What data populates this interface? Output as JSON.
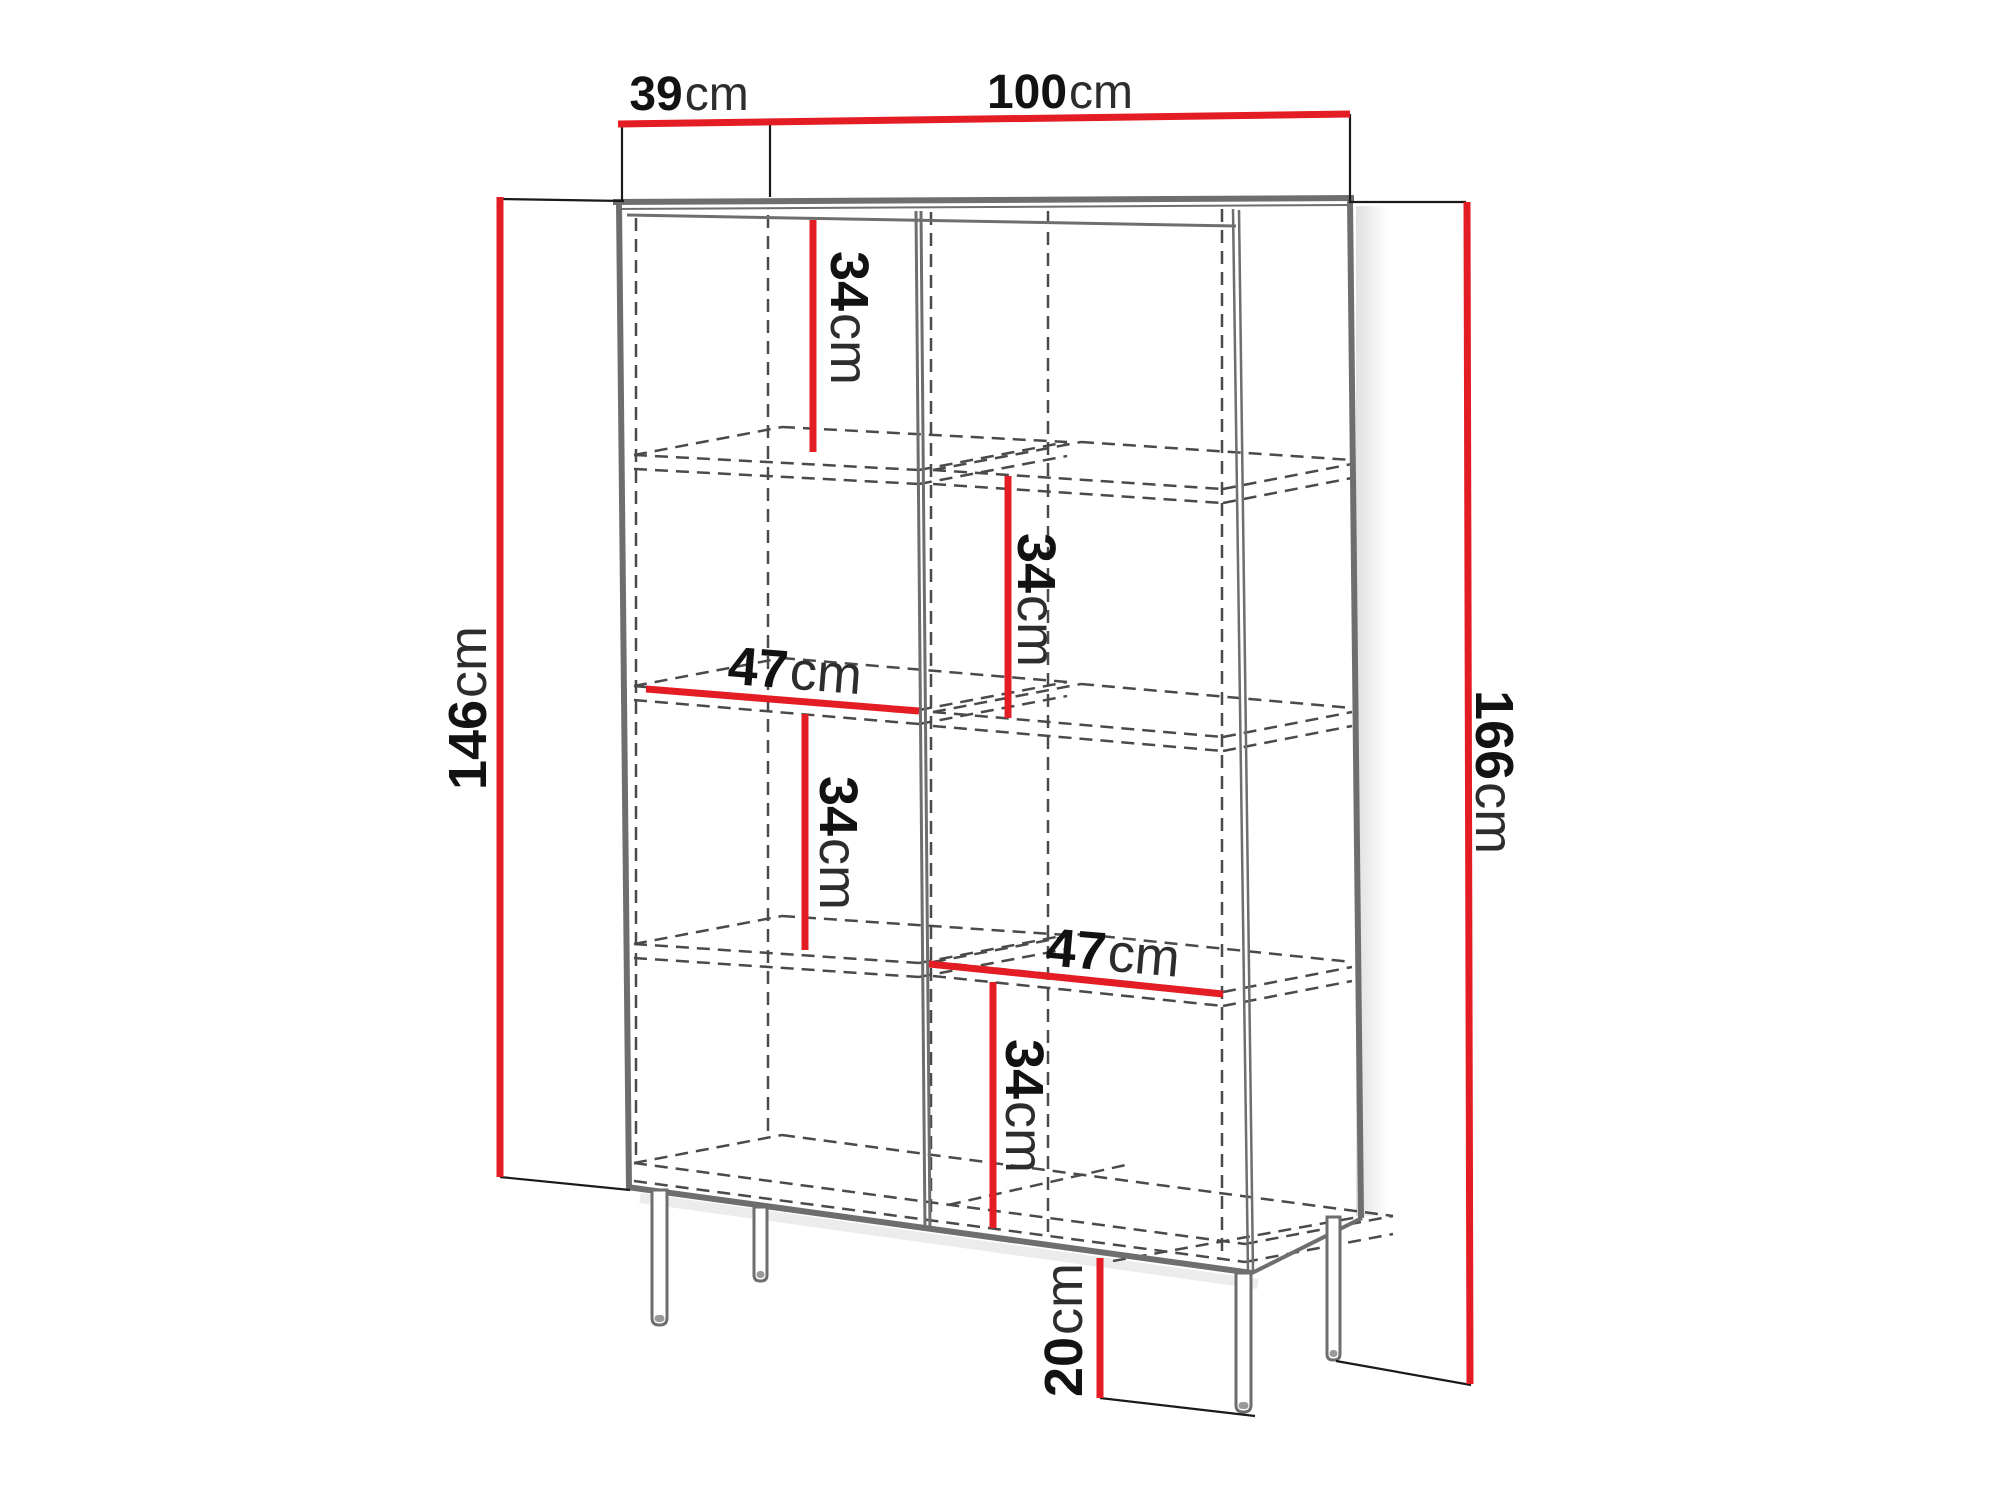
{
  "canvas": {
    "width": 2000,
    "height": 1499,
    "background": "#ffffff"
  },
  "palette": {
    "dimension_red": "#e41c23",
    "cabinet_gray": "#6e6e6e",
    "hidden_gray": "#4a4a4a",
    "extension_black": "#1a1a1a",
    "number_ink": "#121212",
    "unit_ink": "#2d2d2d"
  },
  "cabinet": {
    "solid_edges": [
      {
        "id": "top-outer-edge",
        "x1": 613,
        "y1": 202,
        "x2": 1354,
        "y2": 198,
        "w": 6
      },
      {
        "id": "top-inner-thin-edge",
        "x1": 617,
        "y1": 209,
        "x2": 1350,
        "y2": 205,
        "w": 2
      },
      {
        "id": "top-panel-bottom-edge",
        "x1": 627,
        "y1": 215,
        "x2": 1236,
        "y2": 226,
        "w": 3
      },
      {
        "id": "left-outer-edge",
        "x1": 619,
        "y1": 203,
        "x2": 629,
        "y2": 1189,
        "w": 6
      },
      {
        "id": "bottom-front-edge",
        "x1": 627,
        "y1": 1187,
        "x2": 1252,
        "y2": 1273,
        "w": 6
      },
      {
        "id": "front-right-edge-a",
        "x1": 1233,
        "y1": 209,
        "x2": 1248,
        "y2": 1271,
        "w": 2.5
      },
      {
        "id": "front-right-edge-b",
        "x1": 1239,
        "y1": 210,
        "x2": 1253,
        "y2": 1272,
        "w": 2.5
      },
      {
        "id": "back-right-edge",
        "x1": 1350,
        "y1": 200,
        "x2": 1361,
        "y2": 1218,
        "w": 6
      },
      {
        "id": "side-bottom-edge",
        "x1": 1252,
        "y1": 1273,
        "x2": 1362,
        "y2": 1218,
        "w": 4
      },
      {
        "id": "center-divider-a",
        "x1": 916,
        "y1": 211,
        "x2": 925,
        "y2": 1231,
        "w": 3
      },
      {
        "id": "center-divider-b",
        "x1": 921,
        "y1": 211,
        "x2": 930,
        "y2": 1231,
        "w": 3
      }
    ],
    "hidden_edges": [
      {
        "x1": 636,
        "y1": 218,
        "x2": 636,
        "y2": 1163
      },
      {
        "x1": 768,
        "y1": 215,
        "x2": 768,
        "y2": 1134
      },
      {
        "x1": 931,
        "y1": 212,
        "x2": 931,
        "y2": 1222
      },
      {
        "x1": 1048,
        "y1": 211,
        "x2": 1048,
        "y2": 1236
      },
      {
        "x1": 1222,
        "y1": 209,
        "x2": 1222,
        "y2": 1259
      },
      {
        "x1": 634,
        "y1": 455,
        "x2": 919,
        "y2": 470
      },
      {
        "x1": 634,
        "y1": 469,
        "x2": 919,
        "y2": 484
      },
      {
        "x1": 782,
        "y1": 427,
        "x2": 1067,
        "y2": 442
      },
      {
        "x1": 634,
        "y1": 455,
        "x2": 782,
        "y2": 427
      },
      {
        "x1": 919,
        "y1": 470,
        "x2": 1067,
        "y2": 442
      },
      {
        "x1": 919,
        "y1": 484,
        "x2": 1067,
        "y2": 456
      },
      {
        "x1": 634,
        "y1": 686,
        "x2": 919,
        "y2": 710
      },
      {
        "x1": 634,
        "y1": 700,
        "x2": 919,
        "y2": 724
      },
      {
        "x1": 782,
        "y1": 658,
        "x2": 1067,
        "y2": 682
      },
      {
        "x1": 634,
        "y1": 686,
        "x2": 782,
        "y2": 658
      },
      {
        "x1": 919,
        "y1": 710,
        "x2": 1067,
        "y2": 682
      },
      {
        "x1": 919,
        "y1": 724,
        "x2": 1067,
        "y2": 696
      },
      {
        "x1": 634,
        "y1": 944,
        "x2": 919,
        "y2": 963
      },
      {
        "x1": 634,
        "y1": 958,
        "x2": 919,
        "y2": 977
      },
      {
        "x1": 782,
        "y1": 916,
        "x2": 1067,
        "y2": 935
      },
      {
        "x1": 634,
        "y1": 944,
        "x2": 782,
        "y2": 916
      },
      {
        "x1": 919,
        "y1": 963,
        "x2": 1067,
        "y2": 935
      },
      {
        "x1": 919,
        "y1": 977,
        "x2": 1067,
        "y2": 949
      },
      {
        "x1": 933,
        "y1": 470,
        "x2": 1223,
        "y2": 489
      },
      {
        "x1": 933,
        "y1": 484,
        "x2": 1223,
        "y2": 503
      },
      {
        "x1": 1081,
        "y1": 442,
        "x2": 1352,
        "y2": 460
      },
      {
        "x1": 933,
        "y1": 470,
        "x2": 1081,
        "y2": 442
      },
      {
        "x1": 1223,
        "y1": 489,
        "x2": 1352,
        "y2": 464
      },
      {
        "x1": 1223,
        "y1": 503,
        "x2": 1352,
        "y2": 478
      },
      {
        "x1": 933,
        "y1": 712,
        "x2": 1223,
        "y2": 737
      },
      {
        "x1": 933,
        "y1": 726,
        "x2": 1223,
        "y2": 751
      },
      {
        "x1": 1081,
        "y1": 684,
        "x2": 1352,
        "y2": 708
      },
      {
        "x1": 933,
        "y1": 712,
        "x2": 1081,
        "y2": 684
      },
      {
        "x1": 1223,
        "y1": 737,
        "x2": 1352,
        "y2": 712
      },
      {
        "x1": 1223,
        "y1": 751,
        "x2": 1352,
        "y2": 726
      },
      {
        "x1": 933,
        "y1": 962,
        "x2": 1223,
        "y2": 992
      },
      {
        "x1": 933,
        "y1": 976,
        "x2": 1223,
        "y2": 1006
      },
      {
        "x1": 1081,
        "y1": 934,
        "x2": 1352,
        "y2": 962
      },
      {
        "x1": 933,
        "y1": 962,
        "x2": 1081,
        "y2": 934
      },
      {
        "x1": 1223,
        "y1": 992,
        "x2": 1352,
        "y2": 967
      },
      {
        "x1": 1223,
        "y1": 1006,
        "x2": 1352,
        "y2": 981
      },
      {
        "x1": 634,
        "y1": 1163,
        "x2": 1245,
        "y2": 1244
      },
      {
        "x1": 634,
        "y1": 1181,
        "x2": 1245,
        "y2": 1262
      },
      {
        "x1": 782,
        "y1": 1135,
        "x2": 1393,
        "y2": 1216
      },
      {
        "x1": 634,
        "y1": 1163,
        "x2": 782,
        "y2": 1135
      },
      {
        "x1": 1245,
        "y1": 1244,
        "x2": 1393,
        "y2": 1216
      },
      {
        "x1": 1245,
        "y1": 1262,
        "x2": 1393,
        "y2": 1234
      },
      {
        "x1": 948,
        "y1": 1205,
        "x2": 1130,
        "y2": 1164
      },
      {
        "x1": 1113,
        "y1": 1261,
        "x2": 1364,
        "y2": 1216
      }
    ],
    "legs": [
      {
        "id": "front-left-leg",
        "x": 652,
        "top": 1190,
        "w": 15,
        "bottom": 1325,
        "r": 7
      },
      {
        "id": "rear-left-leg",
        "x": 754,
        "top": 1207,
        "w": 13,
        "bottom": 1281,
        "r": 6
      },
      {
        "id": "front-right-leg",
        "x": 1236,
        "top": 1273,
        "w": 15,
        "bottom": 1412,
        "r": 7
      },
      {
        "id": "rear-right-leg",
        "x": 1327,
        "top": 1217,
        "w": 13,
        "bottom": 1360,
        "r": 6
      }
    ]
  },
  "dimensions": {
    "extension_lines": [
      {
        "x1": 500,
        "y1": 199,
        "x2": 624,
        "y2": 201
      },
      {
        "x1": 500,
        "y1": 1177,
        "x2": 630,
        "y2": 1190
      },
      {
        "x1": 622,
        "y1": 124,
        "x2": 622,
        "y2": 200
      },
      {
        "x1": 770,
        "y1": 121,
        "x2": 770,
        "y2": 197
      },
      {
        "x1": 1350,
        "y1": 114,
        "x2": 1350,
        "y2": 203
      },
      {
        "x1": 1350,
        "y1": 202,
        "x2": 1466,
        "y2": 202
      },
      {
        "x1": 1100,
        "y1": 1398,
        "x2": 1255,
        "y2": 1416
      },
      {
        "x1": 1336,
        "y1": 1361,
        "x2": 1471,
        "y2": 1385
      }
    ],
    "red_lines": [
      {
        "id": "top-dimension",
        "x1": 618,
        "y1": 124,
        "x2": 1350,
        "y2": 114
      },
      {
        "id": "body-height",
        "x1": 500,
        "y1": 197,
        "x2": 500,
        "y2": 1177
      },
      {
        "id": "total-height",
        "x1": 1467,
        "y1": 202,
        "x2": 1470,
        "y2": 1384
      },
      {
        "id": "shelf-a",
        "x1": 813,
        "y1": 220,
        "x2": 813,
        "y2": 452
      },
      {
        "id": "inner-width-left",
        "x1": 646,
        "y1": 689,
        "x2": 919,
        "y2": 711
      },
      {
        "id": "shelf-c",
        "x1": 805,
        "y1": 714,
        "x2": 805,
        "y2": 950
      },
      {
        "id": "shelf-b",
        "x1": 1008,
        "y1": 476,
        "x2": 1008,
        "y2": 718
      },
      {
        "id": "inner-width-right",
        "x1": 929,
        "y1": 964,
        "x2": 1223,
        "y2": 994
      },
      {
        "id": "shelf-d",
        "x1": 993,
        "y1": 982,
        "x2": 993,
        "y2": 1228
      },
      {
        "id": "leg-height",
        "x1": 1100,
        "y1": 1258,
        "x2": 1100,
        "y2": 1398
      }
    ],
    "labels": [
      {
        "id": "depth",
        "value": "39",
        "unit": "cm",
        "x": 689,
        "y": 94,
        "rot": 0,
        "size": 48
      },
      {
        "id": "width",
        "value": "100",
        "unit": "cm",
        "x": 1060,
        "y": 92,
        "rot": 0,
        "size": 48
      },
      {
        "id": "body-height",
        "value": "146",
        "unit": "cm",
        "x": 468,
        "y": 708,
        "rot": -90,
        "size": 54
      },
      {
        "id": "total-height",
        "value": "166",
        "unit": "cm",
        "x": 1494,
        "y": 772,
        "rot": 90,
        "size": 54
      },
      {
        "id": "shelf-a",
        "value": "34",
        "unit": "cm",
        "x": 849,
        "y": 318,
        "rot": 90,
        "size": 54
      },
      {
        "id": "shelf-b",
        "value": "34",
        "unit": "cm",
        "x": 1036,
        "y": 600,
        "rot": 90,
        "size": 54
      },
      {
        "id": "shelf-c",
        "value": "34",
        "unit": "cm",
        "x": 838,
        "y": 843,
        "rot": 90,
        "size": 54
      },
      {
        "id": "shelf-d",
        "value": "34",
        "unit": "cm",
        "x": 1024,
        "y": 1106,
        "rot": 90,
        "size": 54
      },
      {
        "id": "inner-width-left",
        "value": "47",
        "unit": "cm",
        "x": 795,
        "y": 671,
        "rot": 4.5,
        "size": 54
      },
      {
        "id": "inner-width-right",
        "value": "47",
        "unit": "cm",
        "x": 1113,
        "y": 953,
        "rot": 5,
        "size": 54
      },
      {
        "id": "leg-height",
        "value": "20",
        "unit": "cm",
        "x": 1064,
        "y": 1330,
        "rot": -90,
        "size": 54
      }
    ]
  }
}
